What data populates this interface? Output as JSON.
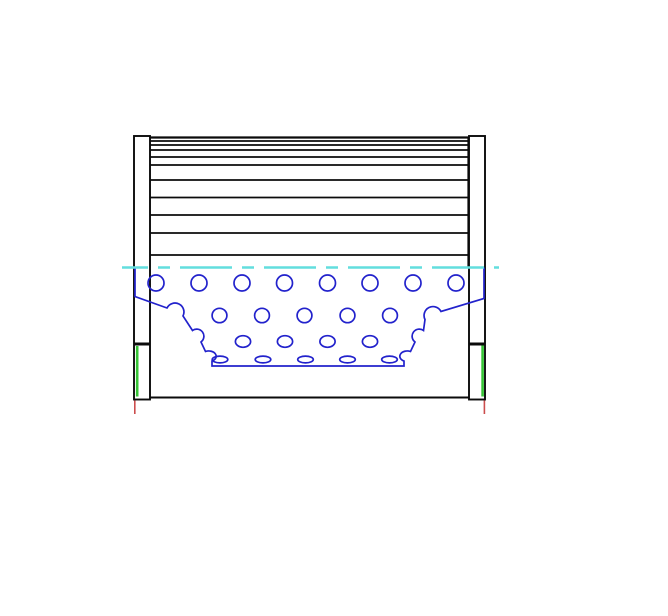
{
  "canvas": {
    "width": 668,
    "height": 616,
    "background": "#ffffff"
  },
  "colors": {
    "outline": "#0b0b0b",
    "core_blue": "#2222cc",
    "centerline_cyan": "#62dede",
    "seal_green": "#35c435",
    "datum_red": "#cc4d4d",
    "fill_white": "#ffffff"
  },
  "pleats": {
    "x1": 149.5,
    "x2": 468.5,
    "top": 137.5,
    "side_bottom": 267.5,
    "lines_y": [
      141,
      145,
      150,
      157,
      165,
      180,
      197.5,
      215,
      233,
      255
    ],
    "edge_stroke": 2.2,
    "line_stroke": 1.8
  },
  "caps": {
    "left": {
      "x": 134,
      "y": 136,
      "w": 16,
      "h": 263.5
    },
    "right": {
      "x": 469,
      "y": 136,
      "w": 16,
      "h": 263.5
    },
    "divider_y": 344,
    "divider_stroke": 3,
    "stroke": 1.9
  },
  "shell_bottom": {
    "x1": 150,
    "x2": 469,
    "y": 397.5,
    "stroke": 1.9
  },
  "centerline": {
    "x1": 122,
    "x2": 499,
    "y": 267.5,
    "stroke": 2.4,
    "dash": "52 10 12 10",
    "dashoffset": 26
  },
  "seals": [
    {
      "x": 137.2,
      "y1": 346,
      "y2": 396.5
    },
    {
      "x": 482.6,
      "y1": 345.5,
      "y2": 396.5
    }
  ],
  "datum_ticks": [
    {
      "x": 134.8,
      "y1": 400.5,
      "y2": 414
    },
    {
      "x": 484.4,
      "y1": 400.5,
      "y2": 414
    }
  ],
  "core": {
    "stroke": 1.7,
    "outline_path": "M 135,267.5 V 296.5 L 167,308 A 8 8 0 0 1 183,316 L 192.5,330.5 A 7 7 0 0 1 201,342 L 205.5,351.5 A 7 5 0 0 1 212,361 V 366 H 404 V 361 A 7 5 0 0 1 410.5,351.5 L 415,342 A 7 7 0 0 1 423.5,330.5 L 425,319.5 A 8 8 0 0 1 441,311.5 L 484,298.5 V 267.5",
    "hole_rows": [
      {
        "y": 283,
        "rx": 8,
        "ry": 8,
        "xs": [
          156,
          199,
          242,
          284.5,
          327.5,
          370,
          413,
          456
        ]
      },
      {
        "y": 315.5,
        "rx": 7.4,
        "ry": 7.2,
        "xs": [
          219.5,
          262,
          304.5,
          347.5,
          390
        ]
      },
      {
        "y": 341.5,
        "rx": 7.6,
        "ry": 5.8,
        "xs": [
          243,
          285,
          327.5,
          370
        ]
      },
      {
        "y": 359.5,
        "rx": 7.8,
        "ry": 3.4,
        "xs": [
          220,
          263,
          305.5,
          347.5,
          389.5
        ]
      }
    ]
  }
}
